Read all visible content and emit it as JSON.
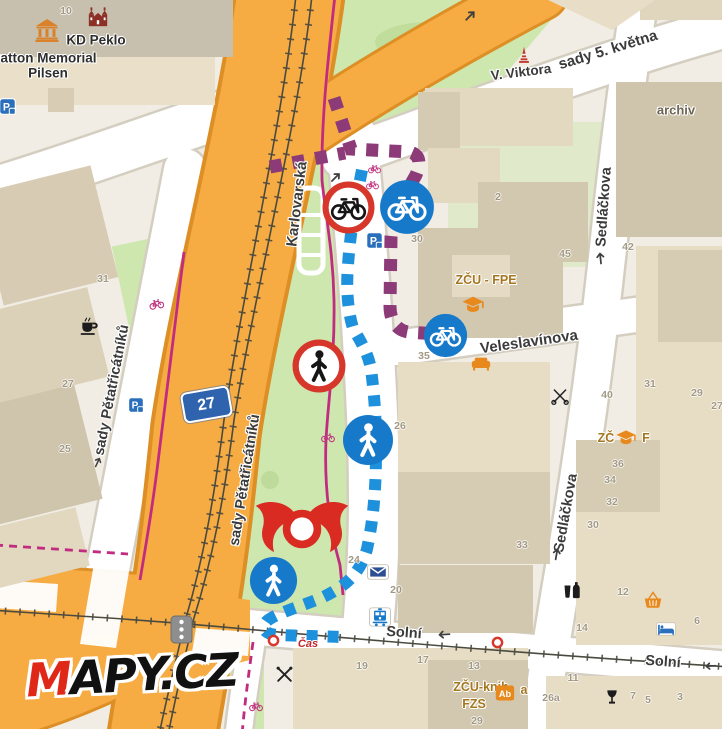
{
  "app": "Mapy.cz",
  "logo": {
    "m": "M",
    "rest": "APY.CZ"
  },
  "road_badge": {
    "text": "27"
  },
  "colors": {
    "route_bike": "#8d3a78",
    "route_foot": "#1e91dc",
    "cycle_path": "#c22c80",
    "poi_blue": "#1779c9",
    "sign_red": "#d7372b",
    "closure_red": "#d92b22",
    "road_orange": "#f6ac42",
    "park_green": "#cde7ae"
  },
  "street_labels": [
    {
      "text": "Karlovarská",
      "x": 297,
      "y": 204,
      "rot": -83,
      "fs": 15
    },
    {
      "text": "sady Pětatřicátníků",
      "x": 112,
      "y": 390,
      "rot": -79,
      "fs": 14.5
    },
    {
      "text": "sady Pětatřicátníků",
      "x": 245,
      "y": 480,
      "rot": -81,
      "fs": 14.5
    },
    {
      "text": "Sedláčkova",
      "x": 604,
      "y": 207,
      "rot": -86,
      "fs": 14.5
    },
    {
      "text": "Sedláčkova",
      "x": 566,
      "y": 513,
      "rot": -80,
      "fs": 14.5
    },
    {
      "text": "Veleslavínova",
      "x": 529,
      "y": 342,
      "rot": -8,
      "fs": 15
    },
    {
      "text": "sady 5. května",
      "x": 608,
      "y": 50,
      "rot": -17,
      "fs": 15
    },
    {
      "text": "V. Viktora",
      "x": 521,
      "y": 72,
      "rot": -7,
      "fs": 13.5
    },
    {
      "text": "Solní",
      "x": 404,
      "y": 633,
      "rot": 4,
      "fs": 14.5
    },
    {
      "text": "Solní",
      "x": 663,
      "y": 662,
      "rot": 4,
      "fs": 14.5
    }
  ],
  "poi_labels": [
    {
      "text": "KD Peklo",
      "x": 96,
      "y": 40,
      "k": "place"
    },
    {
      "text": "Patton Memorial",
      "x": 44,
      "y": 58,
      "k": "place"
    },
    {
      "text": "Pilsen",
      "x": 48,
      "y": 73,
      "k": "place"
    },
    {
      "text": "archiv",
      "x": 676,
      "y": 110,
      "k": "muted"
    },
    {
      "text": "ZČU - FPE",
      "x": 486,
      "y": 280,
      "k": "edu"
    },
    {
      "text": "ZČ",
      "x": 606,
      "y": 438,
      "k": "edu"
    },
    {
      "text": "F",
      "x": 646,
      "y": 438,
      "k": "edu"
    },
    {
      "text": "ZČU-knih",
      "x": 481,
      "y": 687,
      "k": "edu"
    },
    {
      "text": "a",
      "x": 524,
      "y": 690,
      "k": "edu"
    },
    {
      "text": "FZS",
      "x": 474,
      "y": 704,
      "k": "edu"
    },
    {
      "text": "Čas",
      "x": 308,
      "y": 644,
      "k": "brand-red"
    }
  ],
  "house_numbers": [
    {
      "t": "10",
      "x": 66,
      "y": 11
    },
    {
      "t": "31",
      "x": 103,
      "y": 279
    },
    {
      "t": "27",
      "x": 68,
      "y": 384
    },
    {
      "t": "25",
      "x": 65,
      "y": 449
    },
    {
      "t": "30",
      "x": 417,
      "y": 239
    },
    {
      "t": "2",
      "x": 498,
      "y": 197
    },
    {
      "t": "45",
      "x": 565,
      "y": 254
    },
    {
      "t": "42",
      "x": 628,
      "y": 247
    },
    {
      "t": "26",
      "x": 400,
      "y": 426
    },
    {
      "t": "35",
      "x": 424,
      "y": 356
    },
    {
      "t": "33",
      "x": 522,
      "y": 545
    },
    {
      "t": "24",
      "x": 354,
      "y": 560
    },
    {
      "t": "20",
      "x": 396,
      "y": 590
    },
    {
      "t": "40",
      "x": 607,
      "y": 395
    },
    {
      "t": "31",
      "x": 650,
      "y": 384
    },
    {
      "t": "29",
      "x": 697,
      "y": 393
    },
    {
      "t": "27",
      "x": 717,
      "y": 406
    },
    {
      "t": "36",
      "x": 618,
      "y": 464
    },
    {
      "t": "34",
      "x": 610,
      "y": 480
    },
    {
      "t": "32",
      "x": 612,
      "y": 502
    },
    {
      "t": "30",
      "x": 593,
      "y": 525
    },
    {
      "t": "12",
      "x": 623,
      "y": 592
    },
    {
      "t": "6",
      "x": 697,
      "y": 621
    },
    {
      "t": "14",
      "x": 582,
      "y": 628
    },
    {
      "t": "19",
      "x": 362,
      "y": 666
    },
    {
      "t": "17",
      "x": 423,
      "y": 660
    },
    {
      "t": "13",
      "x": 474,
      "y": 666
    },
    {
      "t": "11",
      "x": 573,
      "y": 678
    },
    {
      "t": "26a",
      "x": 551,
      "y": 698
    },
    {
      "t": "7",
      "x": 633,
      "y": 696
    },
    {
      "t": "5",
      "x": 648,
      "y": 700
    },
    {
      "t": "3",
      "x": 680,
      "y": 697
    },
    {
      "t": "29",
      "x": 477,
      "y": 721
    }
  ],
  "icons": [
    {
      "type": "no-bike-sign",
      "x": 348,
      "y": 207,
      "s": 53
    },
    {
      "type": "no-pedestrian-sign",
      "x": 319,
      "y": 366,
      "s": 54
    },
    {
      "type": "bike-route-circle",
      "x": 407,
      "y": 207,
      "s": 56
    },
    {
      "type": "bike-route-circle",
      "x": 445,
      "y": 335,
      "s": 45
    },
    {
      "type": "foot-route-circle",
      "x": 368,
      "y": 440,
      "s": 52
    },
    {
      "type": "foot-route-circle",
      "x": 273,
      "y": 580,
      "s": 49
    },
    {
      "type": "road-closure",
      "x": 302,
      "y": 529,
      "w": 106,
      "h": 66
    },
    {
      "type": "museum",
      "x": 47,
      "y": 30,
      "s": 24
    },
    {
      "type": "civic-building",
      "x": 98,
      "y": 17,
      "s": 22
    },
    {
      "type": "monument",
      "x": 524,
      "y": 55,
      "s": 18
    },
    {
      "type": "parking",
      "x": 7,
      "y": 106,
      "s": 17
    },
    {
      "type": "parking",
      "x": 374,
      "y": 240,
      "s": 17
    },
    {
      "type": "parking",
      "x": 136,
      "y": 405,
      "s": 16
    },
    {
      "type": "cafe",
      "x": 89,
      "y": 326,
      "s": 20
    },
    {
      "type": "graduation-cap",
      "x": 473,
      "y": 304,
      "s": 22
    },
    {
      "type": "graduation-cap",
      "x": 626,
      "y": 437,
      "s": 20
    },
    {
      "type": "sofa",
      "x": 481,
      "y": 363,
      "s": 20
    },
    {
      "type": "post",
      "x": 378,
      "y": 572,
      "s": 22
    },
    {
      "type": "tram-stop",
      "x": 380,
      "y": 617,
      "s": 22
    },
    {
      "type": "restaurant",
      "x": 284,
      "y": 674,
      "s": 19
    },
    {
      "type": "hairdresser",
      "x": 560,
      "y": 396,
      "s": 18
    },
    {
      "type": "drink",
      "x": 572,
      "y": 590,
      "s": 18
    },
    {
      "type": "pub",
      "x": 612,
      "y": 697,
      "s": 16
    },
    {
      "type": "shop-basket",
      "x": 653,
      "y": 600,
      "s": 18
    },
    {
      "type": "hotel",
      "x": 666,
      "y": 629,
      "s": 20
    },
    {
      "type": "library",
      "x": 505,
      "y": 693,
      "s": 20
    },
    {
      "type": "no-entry-dot",
      "x": 273,
      "y": 640,
      "s": 13
    },
    {
      "type": "no-entry-dot",
      "x": 497,
      "y": 642,
      "s": 13
    },
    {
      "type": "cycleway",
      "x": 156,
      "y": 303,
      "s": 15,
      "rot": -10
    },
    {
      "type": "cycleway",
      "x": 374,
      "y": 168,
      "s": 13
    },
    {
      "type": "cycleway",
      "x": 372,
      "y": 184,
      "s": 13
    },
    {
      "type": "cycleway",
      "x": 328,
      "y": 437,
      "s": 14
    },
    {
      "type": "cycleway",
      "x": 256,
      "y": 706,
      "s": 14
    },
    {
      "type": "one-way-arrow",
      "x": 470,
      "y": 16,
      "s": 16,
      "rot": -45
    },
    {
      "type": "one-way-arrow",
      "x": 335,
      "y": 177,
      "s": 15,
      "rot": -45
    },
    {
      "type": "one-way-arrow",
      "x": 600,
      "y": 258,
      "s": 15,
      "rot": -96
    },
    {
      "type": "one-way-arrow",
      "x": 556,
      "y": 554,
      "s": 15,
      "rot": -80
    },
    {
      "type": "one-way-arrow",
      "x": 444,
      "y": 634,
      "s": 15,
      "rot": 176
    },
    {
      "type": "one-way-arrow",
      "x": 711,
      "y": 666,
      "s": 14,
      "rot": 176
    },
    {
      "type": "one-way-arrow",
      "x": 97,
      "y": 462,
      "s": 13,
      "rot": -65
    }
  ]
}
